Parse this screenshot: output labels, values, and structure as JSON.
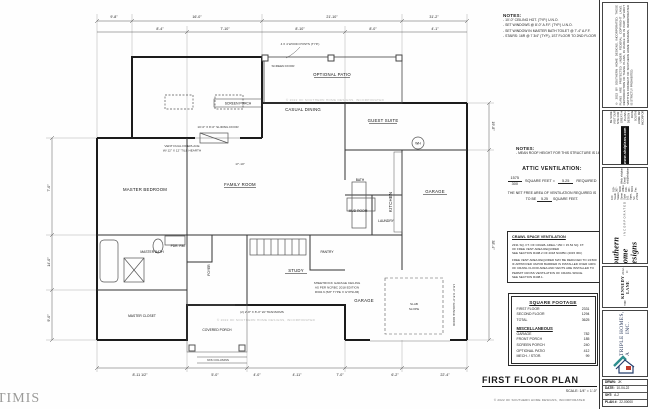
{
  "sheet": {
    "watermark_corner": "TIMIS"
  },
  "notes_top": {
    "title": "NOTES:",
    "items": [
      "-  10'-0\" CEILING HGT. (TYP.) U.N.O.",
      "-  SET WINDOWS @ 8'-0\" A.F.F. (TYP.) U.N.O.",
      "-  SET WINDOW IN MASTER BATH TOILET @ 7'-4\" A.F.F.",
      "-  STAIRS: 16R @ 7 3/4\" (TYP.), 1ST FLOOR TO 2ND FLOOR"
    ]
  },
  "notes_mid": {
    "title": "NOTES:",
    "items": [
      "-  MEAN ROOF HEIGHT FOR THIS STRUCTURE IS 16'-10\""
    ]
  },
  "attic": {
    "title": "ATTIC VENTILATION:",
    "numerator": "1575",
    "denominator": "300",
    "label": "SQUARE FEET =",
    "result": "5.25",
    "required": "REQUIRED",
    "net1": "THE NET FREE AREA OF VENTILATION REQUIRED IS TO BE",
    "net_value": "5.25",
    "net2": "SQUARE FEET."
  },
  "crawl": {
    "title": "CRAWL SPACE VENTILATION",
    "line1": "2331 SQ. FT. OF CRAWL AREA / 150 = 15.54 SQ. FT.",
    "line2": "OF FREE VENT AREA REQUIRED",
    "line3": "SEE SECTION R408.2 OF 2018 NCRBC (2015 IRC)",
    "para": "FREE VENT AREA REQUIRED MAY BE REDUCED TO 1/1500 IF APPROVED VAPOR BARRIER IS INSTALLED OVER 100% OF CRAWL FLOOR AREA AND VENTS ARE INSTALLED TO PERMIT CROSS VENTILATION OF CRAWL SPACE.",
    "line4": "SEE SECTION R408.1."
  },
  "sqft": {
    "title": "SQUARE FOOTAGE",
    "rows": [
      {
        "label": "FIRST FLOOR",
        "value": "2331"
      },
      {
        "label": "SECOND FLOOR",
        "value": "1294"
      },
      {
        "label": "TOTAL",
        "value": "3625"
      }
    ],
    "misc_title": "MISCELLANEOUS",
    "misc": [
      {
        "label": "GARAGE",
        "value": "782"
      },
      {
        "label": "FRONT PORCH",
        "value": "185"
      },
      {
        "label": "SCREEN PORCH",
        "value": "240"
      },
      {
        "label": "OPTIONAL PATIO",
        "value": "412"
      },
      {
        "label": "MECH. / STOR.",
        "value": "99"
      }
    ]
  },
  "plan_title": {
    "text": "FIRST FLOOR PLAN",
    "scale": "SCALE:  1/4\" = 1'-0\"",
    "copyright": "© 2022 OF SOUTHERN HOME DESIGNS, INCORPORATED"
  },
  "rooms": {
    "screen_porch": "SCREEN PORCH",
    "optional_patio": "OPTIONAL PATIO",
    "casual_dining": "CASUAL DINING",
    "guest_suite": "GUEST SUITE",
    "family_room": "FAMILY ROOM",
    "kitchen": "KITCHEN",
    "master_bedroom": "MASTER BEDROOM",
    "master_bath": "MASTER BATH",
    "master_closet": "MASTER CLOSET",
    "foyer": "FOYER",
    "study": "STUDY",
    "covered_porch": "COVERED PORCH",
    "pantry": "PANTRY",
    "mud_room": "MUD ROOM",
    "laundry": "LAUNDRY",
    "garage": "GARAGE",
    "garage2": "GARAGE",
    "powder": "PDR. RM.",
    "guest_bath": "BATH",
    "wh": "WH"
  },
  "annotations": {
    "posts": "4 X 4 WOOD POSTS (TYP.)",
    "screen_door": "SCREEN DOOR",
    "sliding_door": "10'-0\" X 8'-0\" SLIDING DOOR",
    "fireplace1": "VENT DUAL FIREPLACE",
    "fireplace2": "W/ 12\" X 12\" TILE HEARTH",
    "transoms": "(2) 2'-8\" X 8'-0\" W/ TRANSOMS",
    "sheetrock1": "SHEETROCK GARAGE CEILING",
    "sheetrock2": "AS PER NCRBC 2018 EDITION",
    "sheetrock3": "R302.6 (5/8\" TYPE X GYPSUM)",
    "slab1": "SLAB",
    "slab2": "SLOPE",
    "garage_door": "18'-0\" X 8'-0\" GARAGE DOOR",
    "columns": "6X6 COLUMNS",
    "family_dim": "17'-10\"",
    "watermark": "© 2022 OF SOUTHERN HOME DESIGNS, INCORPORATED"
  },
  "dims": {
    "top1": [
      "9'-8\"",
      "16'-0\"",
      "21'-10\"",
      "31'-2\""
    ],
    "top2": [
      "8'-4\"",
      "7'-10\"",
      "8'-10\"",
      "8'-0\"",
      "4'-1\""
    ],
    "left": [
      "7'-0\"",
      "14'-0\"",
      "9'-0\""
    ],
    "right": [
      "19'-8\"",
      "38'-4\""
    ],
    "bottom": [
      "8'-11 1/2\"",
      "5'-0\"",
      "4'-0\"",
      "4'-11\"",
      "7'-0\"",
      "6'-2\"",
      "22'-4\""
    ]
  },
  "titleblock": {
    "disclaimer": "© 2022 BY SOUTHERN HOME DESIGNS, INCORPORATED. THESE PLANS ARE PROTECTED UNDER FEDERAL COPYRIGHT LAWS. REPRODUCTION OF THESE PLANS, IN WHOLE OR IN PART, WITHOUT WRITTEN CONSENT OF SOUTHERN HOME DESIGNS, INCORPORATED IS STRICTLY PROHIBITED.",
    "web_intro": "Hey, visit us @",
    "web_badge": "www.shdplans.com",
    "web_note": "BE SURE AND VISIT OUR WEB SITE FOR MORE GREAT HOME PLANS AND DESIGN IDEAS FROM SOUTHERN HOME DESIGNS, INCORPORATED.",
    "logo": "Southern Home Designs",
    "logo_sub": "INCORPORATED",
    "address1": "100 South Salem Street  Suite 101  Apex, NC 27502",
    "address2": "919-367-6000 Office    919-367-6001 Fax",
    "address3": "Web: shdplans.com    Email: shd@shdplans.com",
    "project_line1": "THE",
    "project_line2": "KENNEDY LANE",
    "project_line3": "2012-D",
    "builder_line1": "TRIPLE A",
    "builder_line2": "HOMES, INC.",
    "info": [
      {
        "label": "DRWN:",
        "value": "JK"
      },
      {
        "label": "DATE:",
        "value": "10-04-22"
      },
      {
        "label": "SHT:",
        "value": "A-2"
      },
      {
        "label": "PLAN #:",
        "value": "22-00000"
      }
    ]
  },
  "colors": {
    "logo_teal": "#2f8f8f",
    "logo_red": "#c03a2b",
    "logo_navy": "#27406e"
  }
}
